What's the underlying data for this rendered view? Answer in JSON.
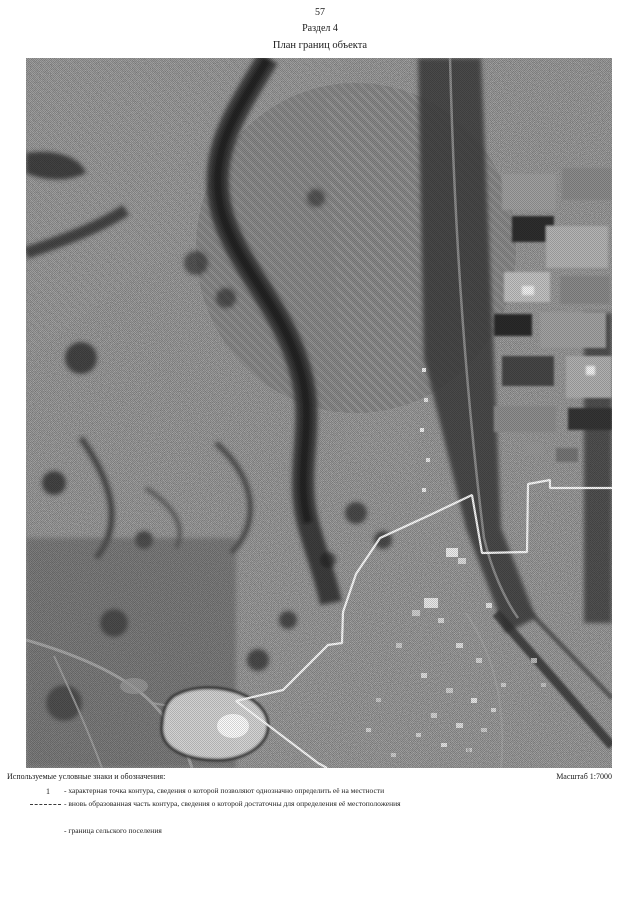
{
  "page": {
    "number": "57",
    "section": "Раздел 4",
    "title": "План границ объекта"
  },
  "map": {
    "scale_label": "Масштаб 1:7000",
    "type": "grayscale aerial photo",
    "boundary_line_color": "#ffffff"
  },
  "legend": {
    "heading": "Используемые условные знаки и обозначения:",
    "items": [
      {
        "symbol": "1",
        "text": "- характерная точка контура, сведения о которой позволяют однозначно определить её на местности"
      },
      {
        "symbol": "",
        "text": "- вновь образованная часть контура, сведения о которой достаточны для определения её местоположения"
      },
      {
        "symbol": "",
        "text": "- граница сельского поселения"
      }
    ]
  }
}
